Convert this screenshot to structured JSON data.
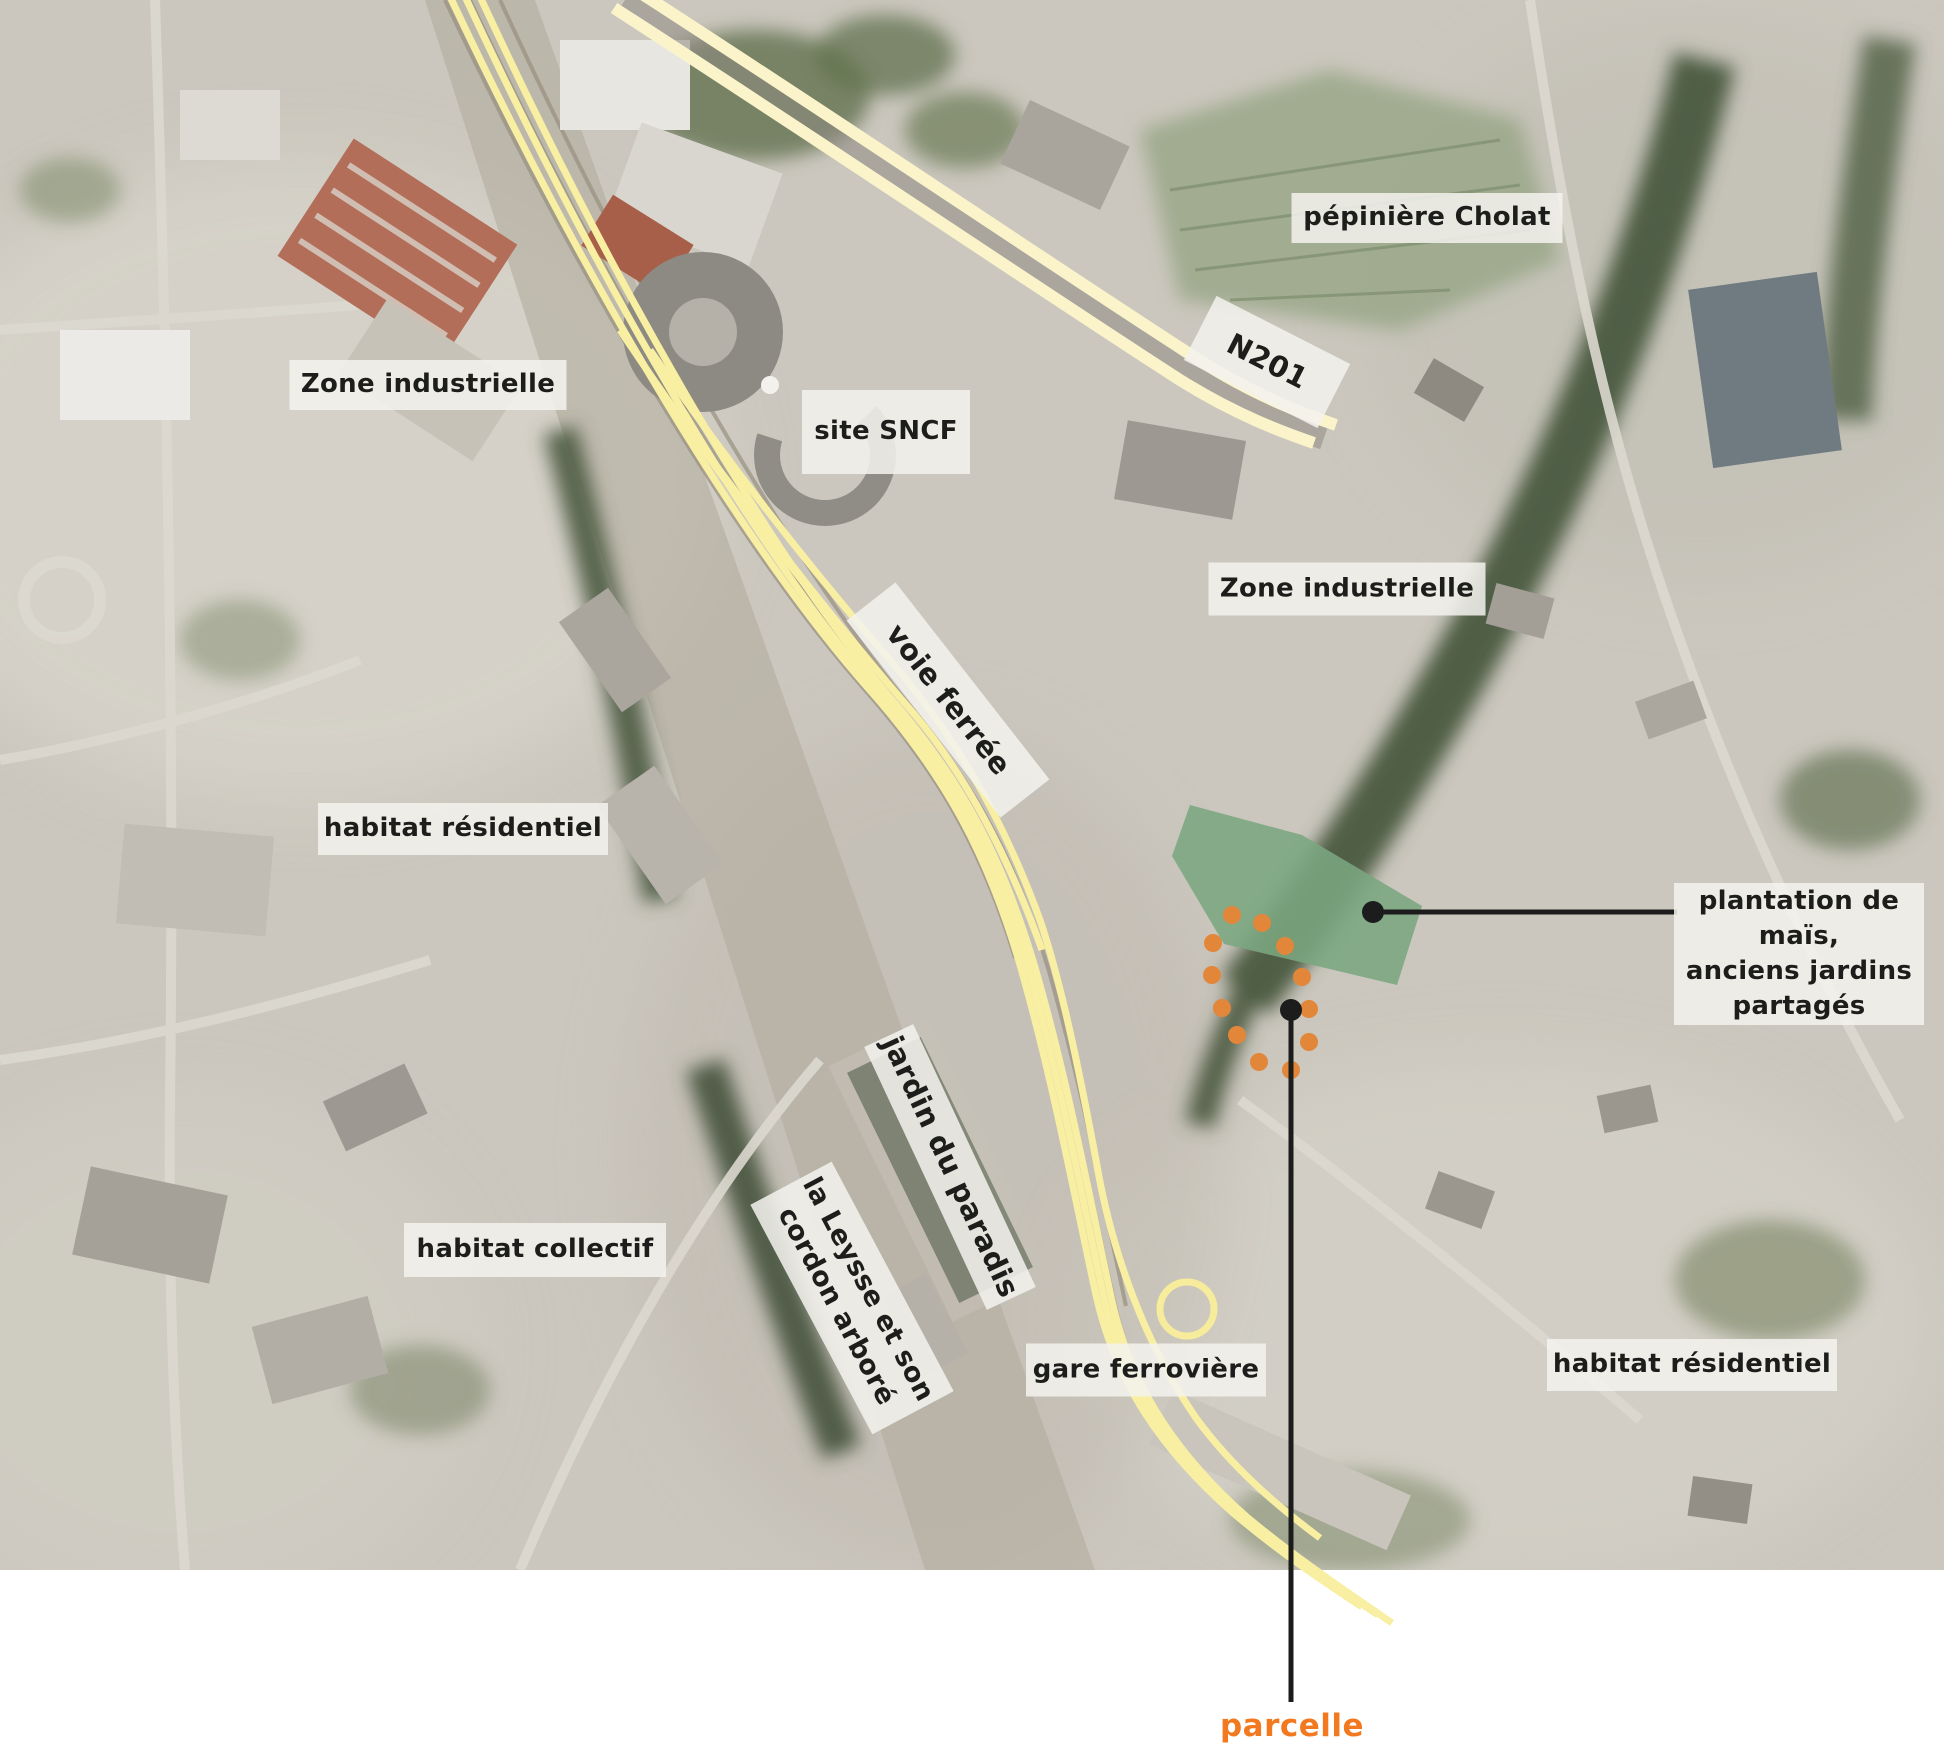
{
  "map": {
    "description": "annotated aerial map of rail-station district",
    "labels": {
      "zone_industrielle_west": "Zone industrielle",
      "site_sncf": "site SNCF",
      "pepiniere_cholat": "pépinière Cholat",
      "n201": "N201",
      "zone_industrielle_east": "Zone industrielle",
      "voie_ferree": "voie ferrée",
      "habitat_residentiel_west": "habitat résidentiel",
      "plantation_line1": "plantation de maïs,",
      "plantation_line2": "anciens jardins",
      "plantation_line3": "partagés",
      "jardin_du_paradis": "jardin du paradis",
      "leysse_line1": "la Leysse et son",
      "leysse_line2": "cordon arboré",
      "habitat_collectif": "habitat collectif",
      "gare_ferroviere": "gare ferrovière",
      "habitat_residentiel_east": "habitat résidentiel",
      "parcelle": "parcelle"
    },
    "markers": {
      "parcelle_outline_dot_count": 12,
      "leader_lines": 2,
      "gare_circle_marker": 1
    },
    "colors": {
      "railway_yellow": "#f8efa2",
      "road_cream": "#fbf4cb",
      "plantation_green": "#7aa67f",
      "parcel_dot_orange": "#e2873a",
      "parcelle_label_orange": "#f2791f",
      "leader_line_black": "#1c1c1c",
      "label_background": "rgba(243,242,238,0.86)",
      "label_text": "#1d1d1b"
    }
  }
}
